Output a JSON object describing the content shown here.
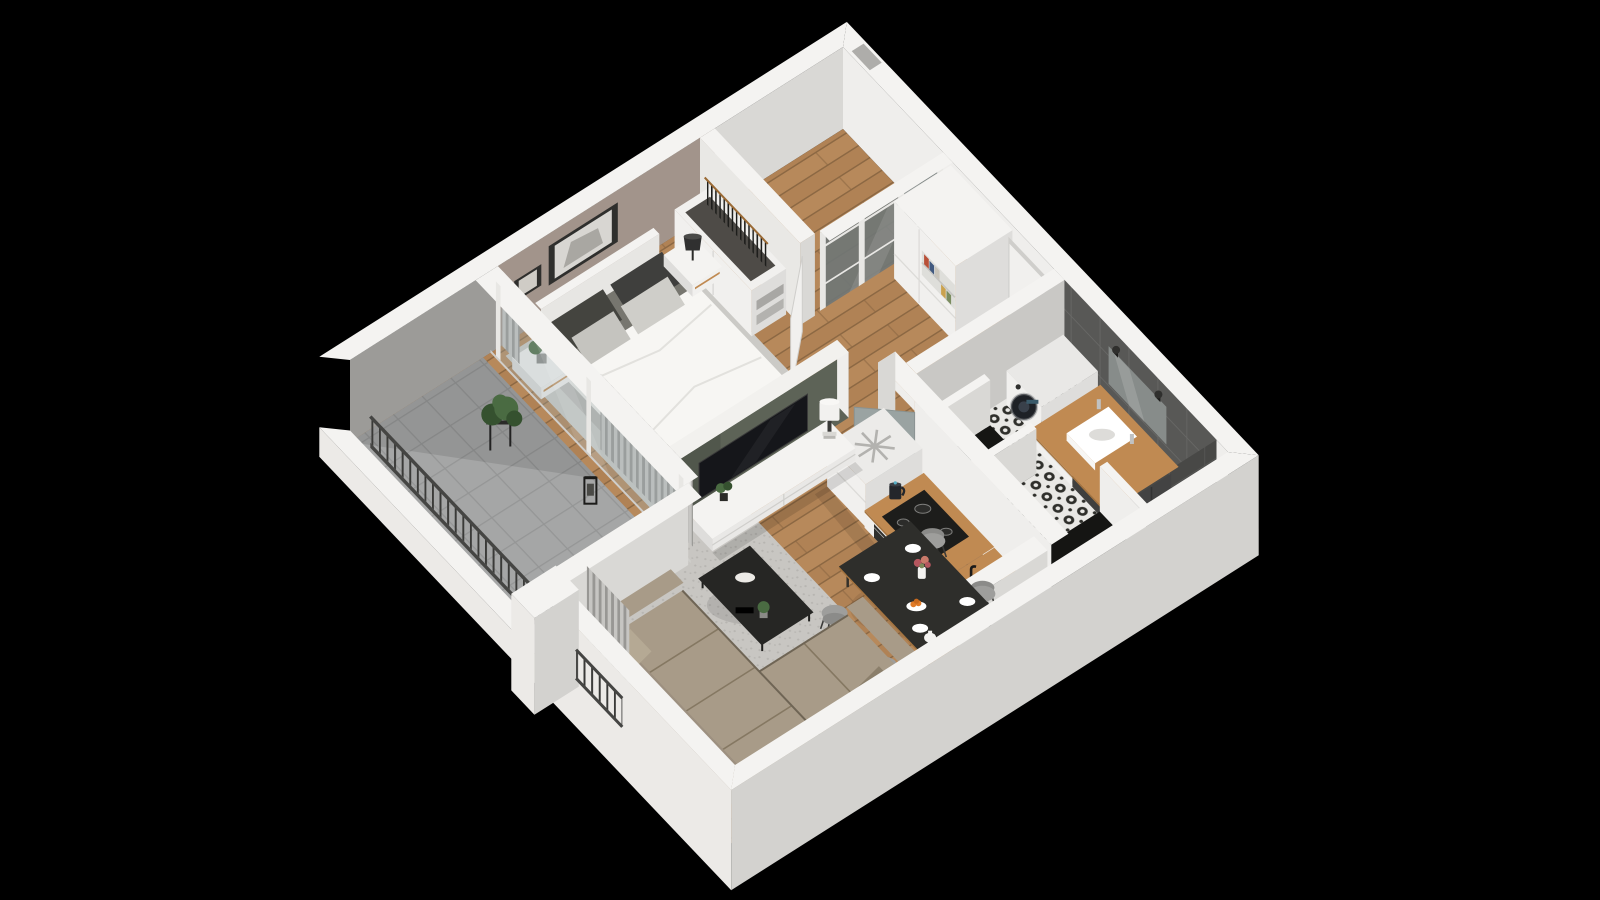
{
  "scene": {
    "type": "isometric-3d-apartment-floor-plan",
    "background": "black",
    "rooms": [
      {
        "name": "bedroom",
        "items": [
          "double-bed",
          "duvet",
          "patterned-pillows",
          "headboard",
          "nightstand-left",
          "potted-plant",
          "nightstand-right",
          "black-table-lamp",
          "wall-art-large",
          "wall-art-small",
          "area-rug",
          "open-wardrobe",
          "hanging-clothes",
          "storage-boxes"
        ]
      },
      {
        "name": "dressing-nook",
        "items": [
          "glass-grid-partition",
          "white-door-open"
        ]
      },
      {
        "name": "hallway",
        "items": [
          "tall-storage-cabinet",
          "bookshelf-niche",
          "entrance-door"
        ]
      },
      {
        "name": "bathroom",
        "items": [
          "washing-machine",
          "wood-vanity-counter",
          "vessel-sink",
          "faucets",
          "mirror",
          "wall-sconces",
          "towel",
          "shower-niche",
          "wc-niche",
          "dark-wall-tiles",
          "patterned-tile-floor",
          "gray-door-open"
        ]
      },
      {
        "name": "kitchen",
        "items": [
          "refrigerator",
          "snowflake-icon",
          "wood-worktop",
          "induction-hob",
          "electric-kettle",
          "oven",
          "black-sink",
          "storage-crate",
          "end-wall"
        ]
      },
      {
        "name": "living-room",
        "items": [
          "olive-tv-wall",
          "tv",
          "tv-stand",
          "white-drum-lamp",
          "small-plant",
          "book-stack",
          "shag-rug",
          "coffee-table",
          "corner-sofa",
          "throw-pillows",
          "window-curtains"
        ]
      },
      {
        "name": "dining-area",
        "items": [
          "black-dining-table",
          "gray-chairs",
          "plates",
          "flower-vase",
          "fruit-bowl",
          "teapot"
        ]
      },
      {
        "name": "balcony",
        "items": [
          "concrete-tile-floor",
          "slat-railing",
          "plant-stand",
          "potted-plant",
          "lantern",
          "glass-sliding-wall",
          "curtains",
          "white-pier"
        ]
      }
    ]
  },
  "colors": {
    "bg": "#000000",
    "rim": "#f4f3f1",
    "extBL": "#eceae7",
    "extBR": "#d3d2cf",
    "innerLit": "#efeeec",
    "innerShade": "#d9d8d5",
    "mauve": "#a2948b",
    "balconyWall": "#9c9b98",
    "notch": "#aeadaa",
    "woodA": "#b7895b",
    "woodB": "#b08255",
    "woodLine": "#8c6843",
    "balcFloor": "#a5a6a6",
    "balcLine": "#959696",
    "rugBed": "#cbcac6",
    "speckA": "#c8c6c2",
    "speckB": "#b7b5b1",
    "tileBase": "#585856",
    "tileLine": "#686866",
    "bathA": "#e9e8e5",
    "bathB": "#2f2f2b",
    "greenWall": "#5d6357",
    "cap": "#f2f1ee",
    "glass": "#9fb0b2",
    "frameWhite": "#e8e7e4",
    "curtA": "#c6c5c2",
    "curtB": "#989794",
    "railBar": "#3a3a38",
    "railTop": "#454543",
    "furnWhite": "#f1f0ee",
    "furnWhiteShade": "#dedddb",
    "furnWhiteDark": "#cfcecb",
    "wood2": "#c08a52",
    "wood2Dark": "#a5743f",
    "dark": "#1d1d1b",
    "darkSoft": "#2f2f2d",
    "steel": "#b0b0ae",
    "duvet": "#f7f6f3",
    "duvetShade": "#ecebe7",
    "mattress": "#77766f",
    "pillowDark": "#3f3f3d",
    "pillowLight": "#cfcec9",
    "sofa": "#a89b88",
    "sofaBack": "#9d9080",
    "sofaShade": "#968974",
    "sofaLine": "#857862",
    "tableBlack": "#2e2e2b",
    "chair": "#9e9e9c",
    "chairDark": "#8b8b89",
    "mirror": "#878c8a",
    "towel": "#434343",
    "doorGray": "#9aa3a2",
    "green1": "#4a6b42",
    "green2": "#35512f",
    "orange": "#e07b28",
    "flower": "#b4565e",
    "white": "#ffffff",
    "tvBlack": "#15161a",
    "lampBlack": "#303030",
    "snow": "#b3b2af",
    "openDark": "#4e4b47",
    "nicheDark": "#151513",
    "bookRed": "#b85038",
    "bookBlue": "#41597f",
    "bookTan": "#caa24e",
    "bookGreen": "#7a8c5f",
    "bookWhite": "#c9c4ba"
  }
}
